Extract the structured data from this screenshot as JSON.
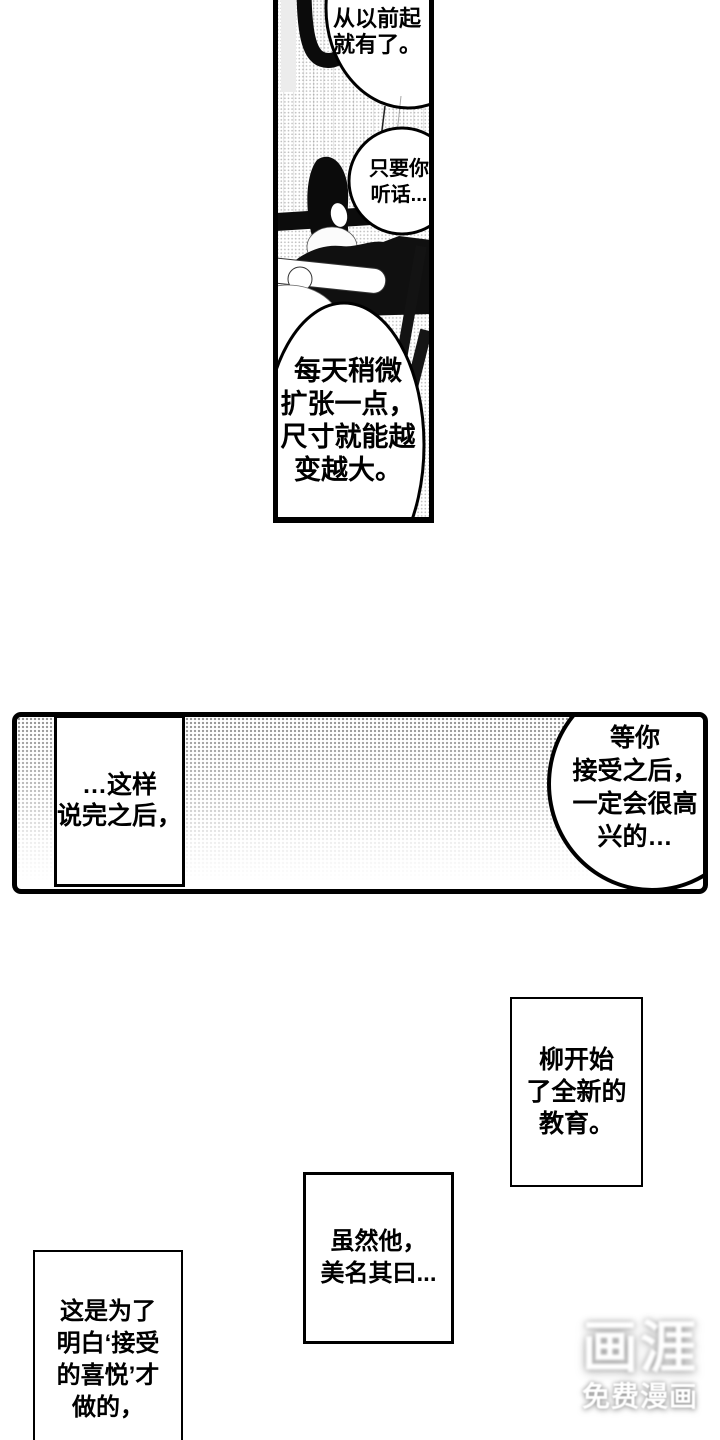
{
  "colors": {
    "ink": "#000000",
    "paper": "#ffffff",
    "halftone_dot": "#8e8e8e",
    "watermark_color": "#ffffff"
  },
  "top_panel": {
    "bubble1": {
      "lines": [
        "从以前起",
        "就有了。"
      ]
    },
    "bubble2": {
      "lines": [
        "只要你",
        "听话..."
      ]
    },
    "bubble3": {
      "lines": [
        "每天稍微",
        "扩张一点，",
        "尺寸就能越",
        "变越大。"
      ]
    }
  },
  "middle_panel": {
    "caption": {
      "lines": [
        "…这样",
        "说完之后，"
      ]
    },
    "bubble": {
      "lines": [
        "等你",
        "接受之后，",
        "一定会很高",
        "兴的…"
      ]
    }
  },
  "captions": {
    "liu": {
      "lines": [
        "柳开始",
        "了全新的",
        "教育。"
      ]
    },
    "suiran": {
      "lines": [
        "虽然他，",
        "美名其曰..."
      ]
    },
    "zheshi": {
      "lines": [
        "这是为了",
        "明白‘接受",
        "的喜悦’才",
        "做的，"
      ]
    }
  },
  "watermark": {
    "logo": "画涯",
    "subtitle": "免费漫画"
  }
}
